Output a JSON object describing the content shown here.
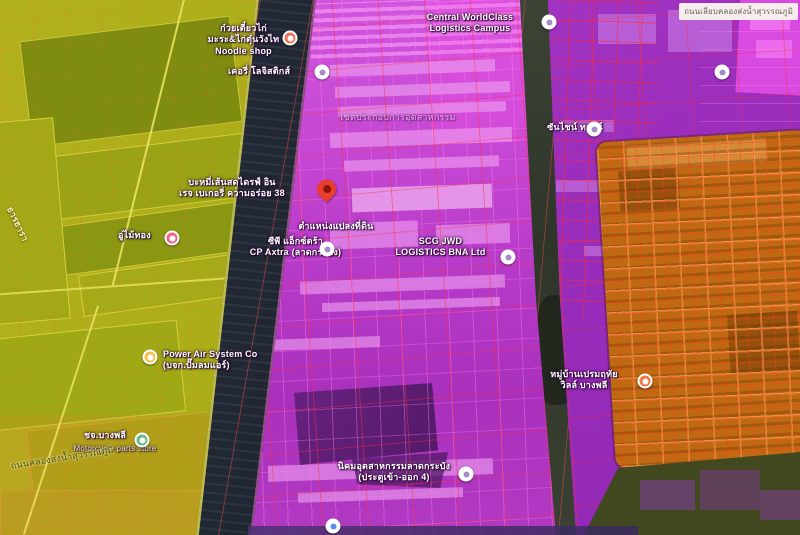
{
  "map": {
    "attribution_box": {
      "text": "ถนนเลียบคลองส่งน้ำสุวรรณภูมิ"
    },
    "colors": {
      "agricultural_overlay": "#a9ae18",
      "canal_dark": "#1c232e",
      "industrial_magenta": "#c446d2",
      "commercial_purple": "#9c2fbe",
      "residential_orange": "#bf6a12",
      "dark_green": "#42481f",
      "cadastral_grid_red": "#ff2d46",
      "destination_pin_red": "#e93d2e"
    },
    "labels": [
      {
        "id": "central-logistics",
        "x": 415,
        "y": 12,
        "w": 110,
        "align": "center",
        "cls": "",
        "interactable": true,
        "lines": [
          "Central WorldClass",
          "Logistics Campus"
        ]
      },
      {
        "id": "noodle-restaurant",
        "x": 196,
        "y": 23,
        "w": 95,
        "align": "center",
        "cls": "",
        "interactable": true,
        "lines": [
          "ก๋วยเตี๋ยวไก่",
          "มะระ&ไก่ตุ๋นวังไท",
          "Noodle shop"
        ]
      },
      {
        "id": "kerry-logistics",
        "x": 228,
        "y": 66,
        "w": 88,
        "align": "left",
        "cls": "",
        "interactable": true,
        "lines": [
          "เคอรี่ โลจิสติกส์"
        ]
      },
      {
        "id": "industrial-area",
        "x": 318,
        "y": 112,
        "w": 160,
        "align": "center",
        "cls": "faint",
        "interactable": false,
        "lines": [
          "เขตประกอบการอุตสาหกรรม"
        ]
      },
      {
        "id": "sunshine-town",
        "x": 543,
        "y": 122,
        "w": 64,
        "align": "center",
        "cls": "",
        "interactable": true,
        "lines": [
          "ซันไชน์ ทาวน์"
        ]
      },
      {
        "id": "bakery-drive-in",
        "x": 158,
        "y": 177,
        "w": 148,
        "align": "center",
        "cls": "",
        "interactable": true,
        "lines": [
          "บะหมี่เส้นสดไดรฟ์ อิน",
          "เรจ เบเกอรี่ ความอร่อย 38"
        ]
      },
      {
        "id": "land-plot-caption",
        "x": 286,
        "y": 221,
        "w": 100,
        "align": "center",
        "cls": "",
        "interactable": false,
        "lines": [
          "ตำแหน่งแปลงที่ดิน"
        ]
      },
      {
        "id": "garage",
        "x": 118,
        "y": 230,
        "w": 52,
        "align": "left",
        "cls": "",
        "interactable": true,
        "lines": [
          "อู่ไม้ทอง"
        ]
      },
      {
        "id": "cp-axtra",
        "x": 243,
        "y": 236,
        "w": 105,
        "align": "center",
        "cls": "",
        "interactable": true,
        "lines": [
          "ซีพี แอ็กซ์ตร้า",
          "CP Axtra (ลาดกระบัง)"
        ]
      },
      {
        "id": "scg-jwd",
        "x": 388,
        "y": 236,
        "w": 105,
        "align": "center",
        "cls": "",
        "interactable": true,
        "lines": [
          "SCG JWD",
          "LOGISTICS BNA Ltd"
        ]
      },
      {
        "id": "power-air",
        "x": 163,
        "y": 349,
        "w": 115,
        "align": "left",
        "cls": "",
        "interactable": true,
        "lines": [
          "Power Air System Co",
          "(บจก.ปั๊มลมแอร์)"
        ]
      },
      {
        "id": "village-premruetai",
        "x": 534,
        "y": 369,
        "w": 100,
        "align": "center",
        "cls": "",
        "interactable": true,
        "lines": [
          "หมู่บ้านเปรมฤทัย",
          "วิลล์ บางพลี"
        ]
      },
      {
        "id": "bangphli-store",
        "x": 84,
        "y": 430,
        "w": 52,
        "align": "left",
        "cls": "",
        "interactable": true,
        "lines": [
          "ชจ.บางพลี"
        ]
      },
      {
        "id": "motorcycle-store-caption",
        "x": 56,
        "y": 444,
        "w": 118,
        "align": "center",
        "cls": "sub",
        "interactable": false,
        "lines": [
          "Motorcycle parts store"
        ]
      },
      {
        "id": "industrial-estate-gate",
        "x": 330,
        "y": 461,
        "w": 128,
        "align": "center",
        "cls": "",
        "interactable": true,
        "lines": [
          "นิคมอุตสาหกรรมลาดกระบัง",
          "(ประตูเข้า-ออก 4)"
        ]
      },
      {
        "id": "road-canal-name",
        "x": 10,
        "y": 461,
        "align": "left",
        "cls": "road",
        "rotate": -9,
        "interactable": false,
        "lines": [
          "ถนนคลองส่งน้ำสุวรรณภูมิ"
        ]
      },
      {
        "id": "road-thara-name",
        "x": 14,
        "y": 205,
        "align": "left",
        "cls": "road-light",
        "rotate": 64,
        "interactable": false,
        "lines": [
          "ธารธารา"
        ]
      }
    ],
    "pins": [
      {
        "id": "noodle-restaurant",
        "icon": "restaurant",
        "x": 290,
        "y": 38,
        "bg": "#f3705a",
        "dot": "#ffffff"
      },
      {
        "id": "central-logistics",
        "icon": "place",
        "x": 549,
        "y": 22,
        "bg": "#ffffff",
        "dot": "#a58cc8"
      },
      {
        "id": "kerry-logistics",
        "icon": "place",
        "x": 322,
        "y": 72,
        "bg": "#ffffff",
        "dot": "#a58cc8"
      },
      {
        "id": "warehouse-ne",
        "icon": "place",
        "x": 722,
        "y": 72,
        "bg": "#ffffff",
        "dot": "#a58cc8"
      },
      {
        "id": "sunshine-town",
        "icon": "place",
        "x": 594,
        "y": 129,
        "bg": "#ffffff",
        "dot": "#a58cc8"
      },
      {
        "id": "garage",
        "icon": "store",
        "x": 172,
        "y": 238,
        "bg": "#f26389",
        "dot": "#ffffff"
      },
      {
        "id": "land-plot",
        "icon": "destination",
        "x": 327,
        "y": 203,
        "bg": "#e93d2e",
        "dot": "#8c1206",
        "type": "destination"
      },
      {
        "id": "cp-axtra",
        "icon": "place",
        "x": 327,
        "y": 249,
        "bg": "#ffffff",
        "dot": "#a58cc8"
      },
      {
        "id": "scg-jwd",
        "icon": "place",
        "x": 508,
        "y": 257,
        "bg": "#ffffff",
        "dot": "#a58cc8"
      },
      {
        "id": "power-air",
        "icon": "business",
        "x": 150,
        "y": 357,
        "bg": "#f2c14e",
        "dot": "#ffffff"
      },
      {
        "id": "bangphli-store",
        "icon": "shopping",
        "x": 142,
        "y": 440,
        "bg": "#69b98c",
        "dot": "#ffffff"
      },
      {
        "id": "industrial-gate",
        "icon": "place",
        "x": 466,
        "y": 474,
        "bg": "#ffffff",
        "dot": "#a58cc8"
      },
      {
        "id": "village",
        "icon": "home",
        "x": 645,
        "y": 381,
        "bg": "#ed7a45",
        "dot": "#ffffff"
      },
      {
        "id": "school-south",
        "icon": "school",
        "x": 333,
        "y": 526,
        "bg": "#ffffff",
        "dot": "#5b8def"
      }
    ]
  }
}
